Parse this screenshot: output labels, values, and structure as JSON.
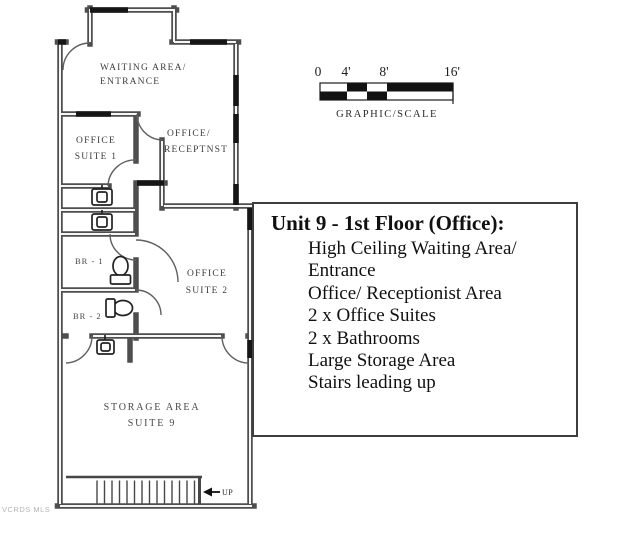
{
  "plan": {
    "waiting_area": [
      "WAITING AREA/",
      "ENTRANCE"
    ],
    "office_suite_1": [
      "OFFICE",
      "SUITE 1"
    ],
    "reception": [
      "OFFICE/",
      "RECEPTNST"
    ],
    "br_1": "BR - 1",
    "br_2": "BR - 2",
    "office_suite_2": [
      "OFFICE",
      "SUITE 2"
    ],
    "storage": [
      "STORAGE AREA",
      "SUITE 9"
    ],
    "up_label": "UP"
  },
  "scale_bar": {
    "ticks": [
      "0",
      "4'",
      "8'",
      "16'"
    ],
    "caption": "GRAPHIC/SCALE"
  },
  "info_box": {
    "title": "Unit 9 - 1st Floor (Office):",
    "items": [
      "High Ceiling Waiting Area/",
      "Entrance",
      "Office/ Receptionist Area",
      "2 x Office Suites",
      "2 x Bathrooms",
      "Large Storage Area",
      "Stairs leading up"
    ]
  },
  "watermark": "VCRDS MLS",
  "colors": {
    "wall": "#4e4e4e",
    "wall_accent": "#161616",
    "label": "#3d3d3d",
    "box_border": "#3e3e3e",
    "watermark": "#b5b5b5"
  }
}
